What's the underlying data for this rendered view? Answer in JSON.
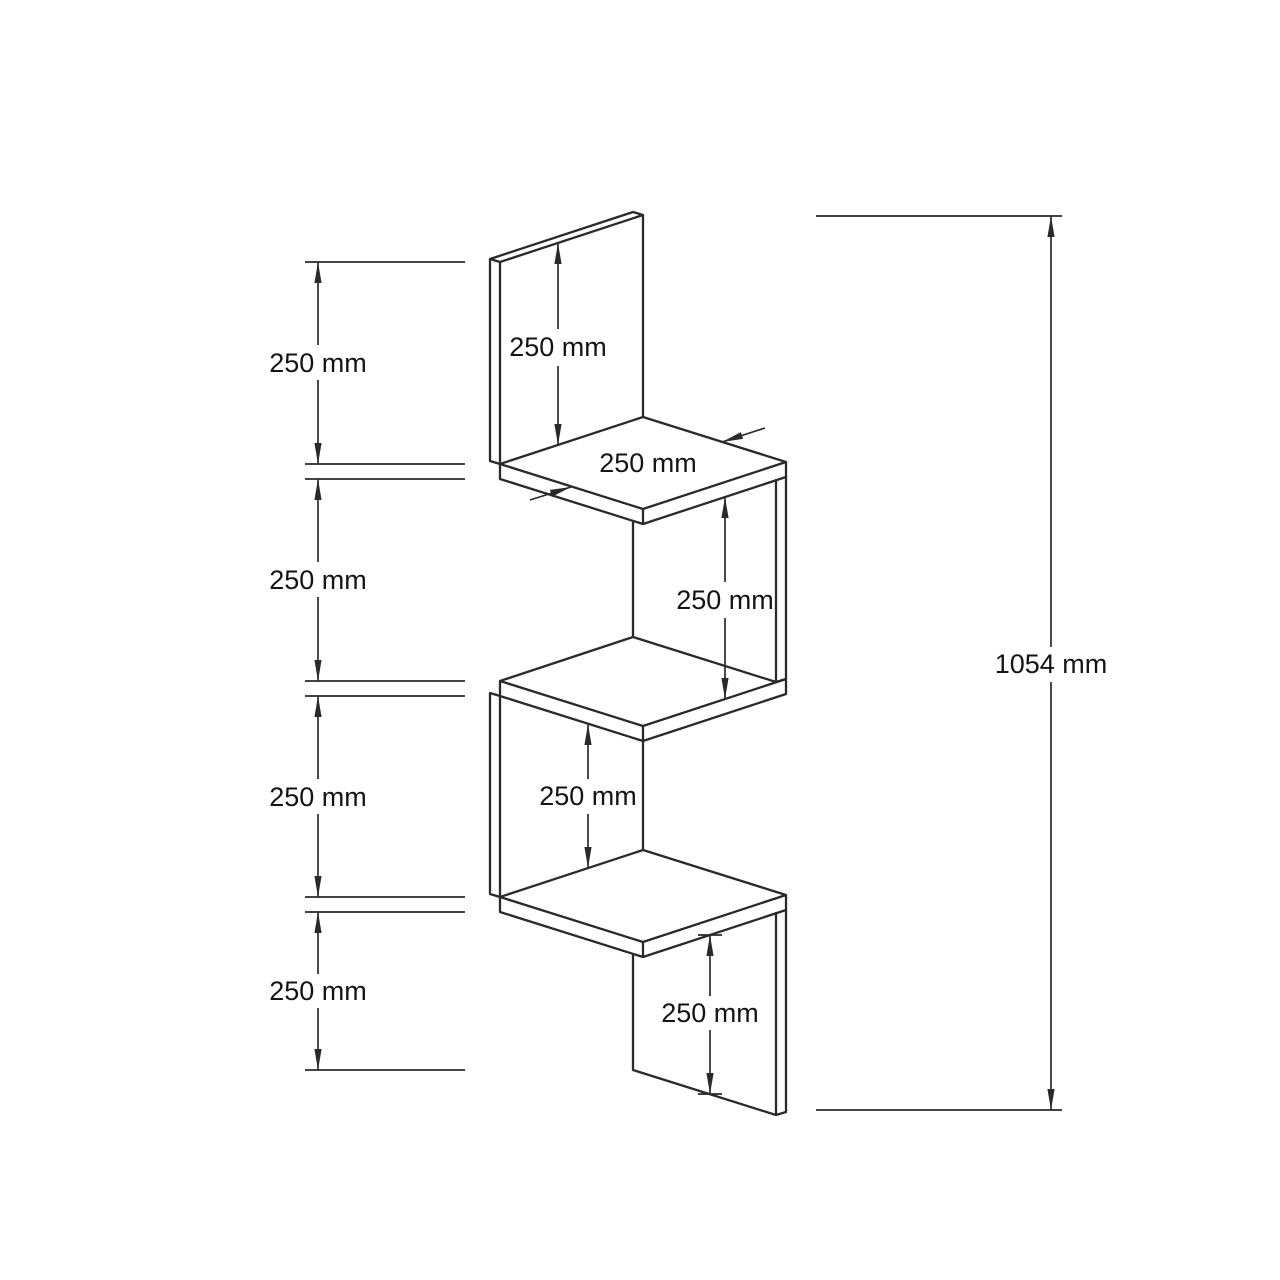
{
  "drawing": {
    "type": "technical-dimension-drawing",
    "subject": "zigzag corner wall shelf, isometric line drawing with dimension annotations",
    "units": "mm"
  },
  "dimensions": {
    "left": [
      {
        "label": "250 mm"
      },
      {
        "label": "250 mm"
      },
      {
        "label": "250 mm"
      },
      {
        "label": "250 mm"
      }
    ],
    "overall": {
      "label": "1054 mm"
    },
    "internal": {
      "back_panel_height": {
        "label": "250 mm"
      },
      "top_shelf_depth": {
        "label": "250 mm"
      },
      "right_panel_height": {
        "label": "250 mm"
      },
      "left_panel_height": {
        "label": "250 mm"
      },
      "bottom_panel_height": {
        "label": "250 mm"
      }
    }
  },
  "colors": {
    "line": "#2a2a2a",
    "text": "#141414",
    "bg": "#ffffff"
  }
}
